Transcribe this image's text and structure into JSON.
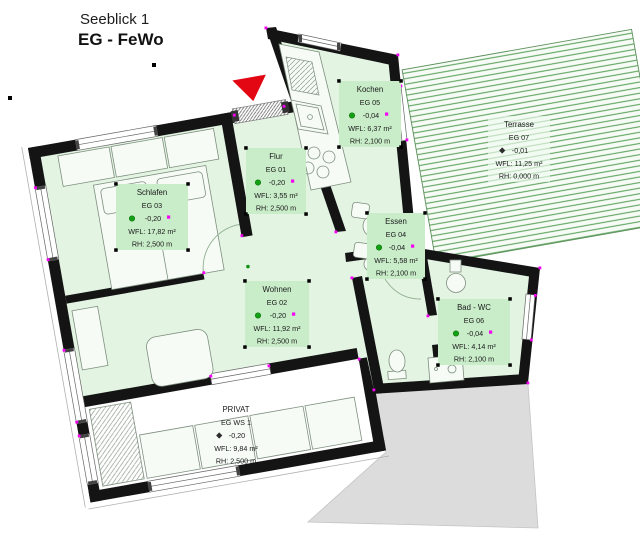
{
  "title": {
    "project": "Seeblick 1",
    "floor": "EG - FeWo"
  },
  "rooms": {
    "schlafen": {
      "name": "Schlafen",
      "code": "EG 03",
      "level": "-0,20",
      "area": "WFL: 17,82 m²",
      "height": "RH: 2,500 m"
    },
    "flur": {
      "name": "Flur",
      "code": "EG 01",
      "level": "-0,20",
      "area": "WFL: 3,55 m²",
      "height": "RH: 2,500 m"
    },
    "wohnen": {
      "name": "Wohnen",
      "code": "EG 02",
      "level": "-0,20",
      "area": "WFL: 11,92 m²",
      "height": "RH: 2,500 m"
    },
    "essen": {
      "name": "Essen",
      "code": "EG 04",
      "level": "-0,04",
      "area": "WFL: 5,58 m²",
      "height": "RH: 2,100 m"
    },
    "kochen": {
      "name": "Kochen",
      "code": "EG 05",
      "level": "-0,04",
      "area": "WFL: 6,37 m²",
      "height": "RH: 2,100 m"
    },
    "bad": {
      "name": "Bad - WC",
      "code": "EG 06",
      "level": "-0,04",
      "area": "WFL: 4,14 m²",
      "height": "RH: 2,100 m"
    },
    "terrasse": {
      "name": "Terrasse",
      "code": "EG 07",
      "level": "-0,01",
      "area": "WFL: 11,25 m²",
      "height": "RH: 0,000 m"
    },
    "privat": {
      "name": "PRIVAT",
      "code": "EG WS 1",
      "level": "-0,20",
      "area": "WFL: 9,84 m²",
      "height": "RH: 2,500 m"
    }
  },
  "colors": {
    "unit_fill": "#e3f4e3",
    "label_fill": "#c9ecc9",
    "wall": "#141414",
    "terrace_hatch": "#4f9a4f",
    "cad_node": "#f500f5",
    "level_marker": "#14a014",
    "entrance_arrow": "#e30613",
    "neighbor_fill": "#dcdcdc"
  }
}
